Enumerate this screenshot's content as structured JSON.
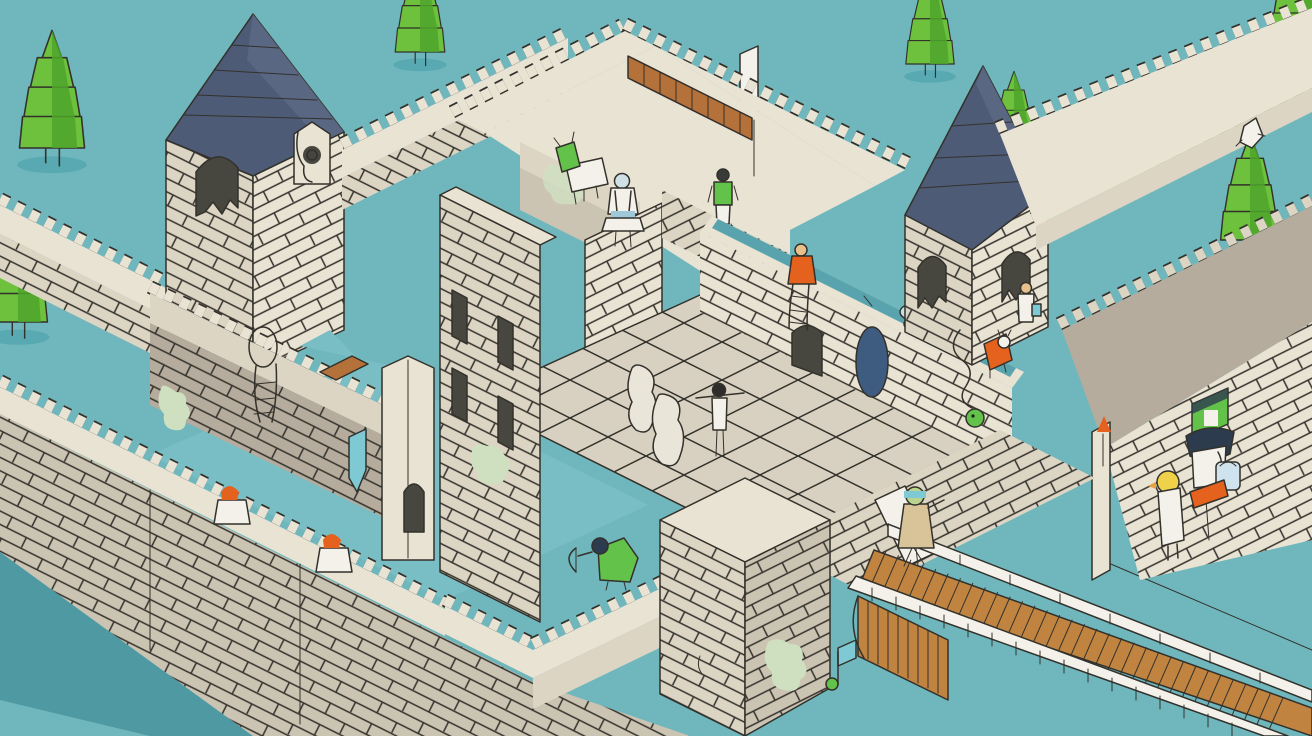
{
  "scene": {
    "title": "Isometric castle illustration",
    "subtitle": "Stylized flat-color castle keep with moat, ramparts, bridge and tiny inhabitants"
  },
  "palette": {
    "bg": "#6fb7bd",
    "waterDark": "#4f99a3",
    "waterLight": "#79bec5",
    "channel": "#58a3ad",
    "wallLight": "#e9e3d4",
    "wallCream": "#dcd5c4",
    "wallMid": "#ccc4b3",
    "wallDark": "#b5ac9d",
    "line": "#33312b",
    "roofL": "#4e5b76",
    "roofR": "#5c6a86",
    "treeL": "#6dc13c",
    "treeD": "#4da52b",
    "treeShadow": "#58a9b1",
    "wood": "#c08440",
    "stairs": "#b5713a",
    "orange": "#e4621d",
    "rope": "#c8862e",
    "mirror": "#3e5c80",
    "navy": "#2d3b4e",
    "green": "#63c24a",
    "paleGreen": "#cfe0c0",
    "white": "#f3f1ea",
    "tealBanner": "#7ec9d3",
    "skin": "#e8c08c",
    "slate": "#474740"
  },
  "entities": [
    {
      "label": "moat water",
      "kind": "terrain"
    },
    {
      "label": "shoreline",
      "kind": "terrain"
    },
    {
      "label": "pine tree top left",
      "kind": "tree"
    },
    {
      "label": "pine tree left edge",
      "kind": "tree"
    },
    {
      "label": "pine tree top center",
      "kind": "tree"
    },
    {
      "label": "pine tree top right",
      "kind": "tree"
    },
    {
      "label": "pine tree right",
      "kind": "tree"
    },
    {
      "label": "tree climber",
      "kind": "character"
    },
    {
      "label": "pine tree corner",
      "kind": "tree"
    },
    {
      "label": "northwest outer wall",
      "kind": "wall"
    },
    {
      "label": "left tower with blue roof",
      "kind": "building"
    },
    {
      "label": "tower shrine",
      "kind": "object"
    },
    {
      "label": "upper curtain wall",
      "kind": "wall"
    },
    {
      "label": "central keep",
      "kind": "building"
    },
    {
      "label": "wooden staircase",
      "kind": "object"
    },
    {
      "label": "goat creature",
      "kind": "character"
    },
    {
      "label": "white knight",
      "kind": "character"
    },
    {
      "label": "lookout in green vest",
      "kind": "character"
    },
    {
      "label": "terrace wall with water channel",
      "kind": "wall"
    },
    {
      "label": "orange robed sitter",
      "kind": "character"
    },
    {
      "label": "ladder creature",
      "kind": "character"
    },
    {
      "label": "hanging wall mirror",
      "kind": "object"
    },
    {
      "label": "mushroom stool",
      "kind": "object"
    },
    {
      "label": "right tower with blue roof",
      "kind": "building"
    },
    {
      "label": "visitor at tower window",
      "kind": "character"
    },
    {
      "label": "green snake",
      "kind": "character"
    },
    {
      "label": "orange cat creature",
      "kind": "character"
    },
    {
      "label": "northeast rampart",
      "kind": "wall"
    },
    {
      "label": "southeast rampart with stall",
      "kind": "wall"
    },
    {
      "label": "duck vendor",
      "kind": "character"
    },
    {
      "label": "orange sign",
      "kind": "object"
    },
    {
      "label": "courtyard with grid floor",
      "kind": "terrain"
    },
    {
      "label": "ghost statues",
      "kind": "character"
    },
    {
      "label": "pole performer",
      "kind": "character"
    },
    {
      "label": "inner water pool",
      "kind": "terrain"
    },
    {
      "label": "keep annex with slit windows",
      "kind": "building"
    },
    {
      "label": "left rampart walk",
      "kind": "wall"
    },
    {
      "label": "corner turret",
      "kind": "building"
    },
    {
      "label": "southwest outer wall",
      "kind": "wall"
    },
    {
      "label": "redhead sentry one",
      "kind": "character"
    },
    {
      "label": "redhead sentry two",
      "kind": "character"
    },
    {
      "label": "lower crenellated wall",
      "kind": "wall"
    },
    {
      "label": "gate house",
      "kind": "building"
    },
    {
      "label": "music note flag",
      "kind": "object"
    },
    {
      "label": "green archer",
      "kind": "character"
    },
    {
      "label": "gate wall",
      "kind": "wall"
    },
    {
      "label": "wooden bridge",
      "kind": "structure"
    },
    {
      "label": "camera creature",
      "kind": "character"
    }
  ]
}
